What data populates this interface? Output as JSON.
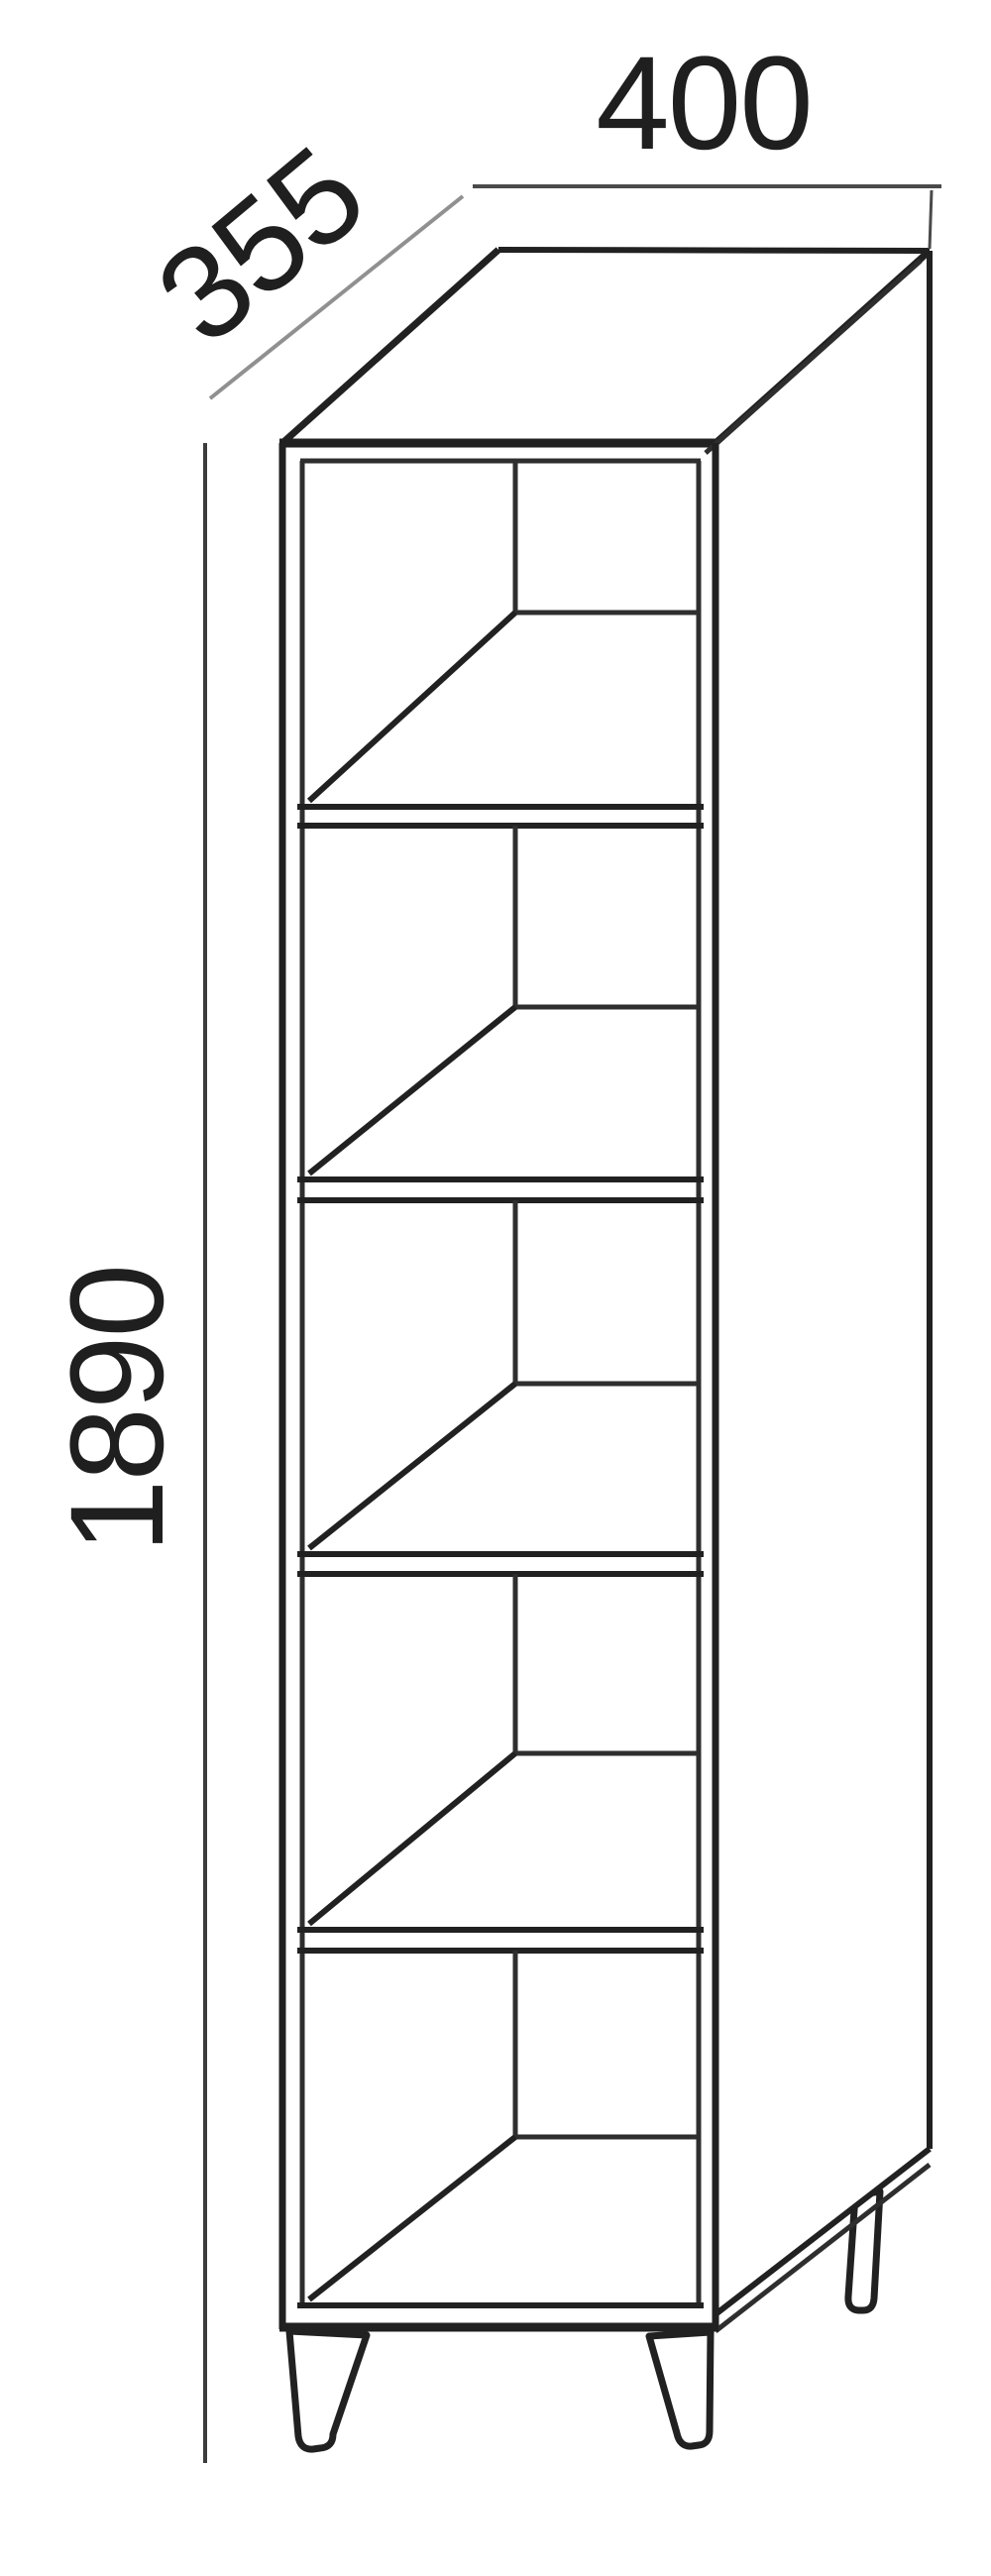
{
  "diagram": {
    "type": "furniture-dimension-drawing",
    "item": "Tall narrow open shelving cabinet, isometric view, five equal compartments, splayed tapered legs",
    "labels": {
      "width": "400",
      "depth": "355",
      "height": "1890"
    },
    "shelf_compartments": 5,
    "visible_legs": 3,
    "colors": {
      "background": "#ffffff",
      "outline": "#212121",
      "width_dimension_line": "#4a4a4a",
      "height_dimension_line": "#3c3c3c",
      "depth_dimension_line": "#909090",
      "label_text": "#1f1f1f"
    }
  }
}
